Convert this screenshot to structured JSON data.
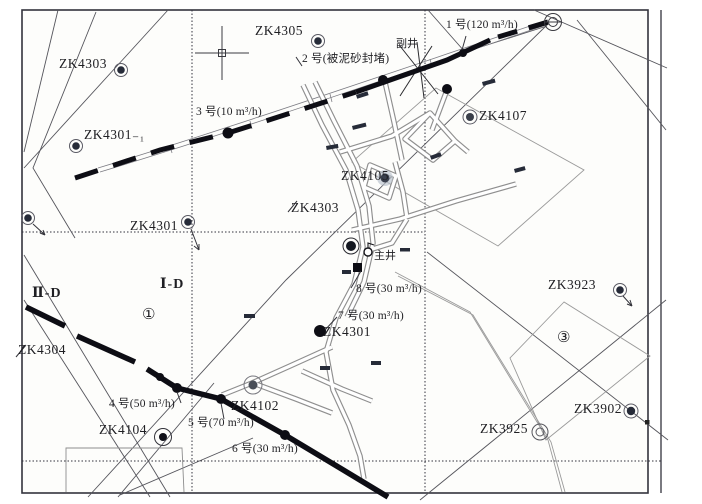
{
  "map_labels": {
    "boreholes": [
      "ZK4303",
      "ZK4305",
      "ZK4301₋₁",
      "ZK4107",
      "ZK4105",
      "ZK4303",
      "ZK4301",
      "ZK4301",
      "ZK4304",
      "ZK4102",
      "ZK4104",
      "ZK3923",
      "ZK3902",
      "ZK3925"
    ],
    "inflow_points": [
      "1 号(120 m³/h)",
      "2 号(被泥砂封堵)",
      "3 号(10 m³/h)",
      "4 号(50 m³/h)",
      "5 号(70 m³/h)",
      "6 号(30 m³/h)",
      "7 号(30 m³/h)",
      "8 号(30 m³/h)"
    ],
    "shafts": {
      "main": "主井",
      "auxiliary": "副井"
    },
    "section_lines": {
      "line_I": "Ⅰ-D",
      "line_II": "Ⅱ-D"
    },
    "zones": {
      "zone1": "①",
      "zone3": "③"
    }
  },
  "colors": {
    "fault": "#0d0d14",
    "grid": "#33333d",
    "tunnel": "#8f8f8f",
    "bhfill": "#262b38",
    "text": "#1f1f23"
  }
}
